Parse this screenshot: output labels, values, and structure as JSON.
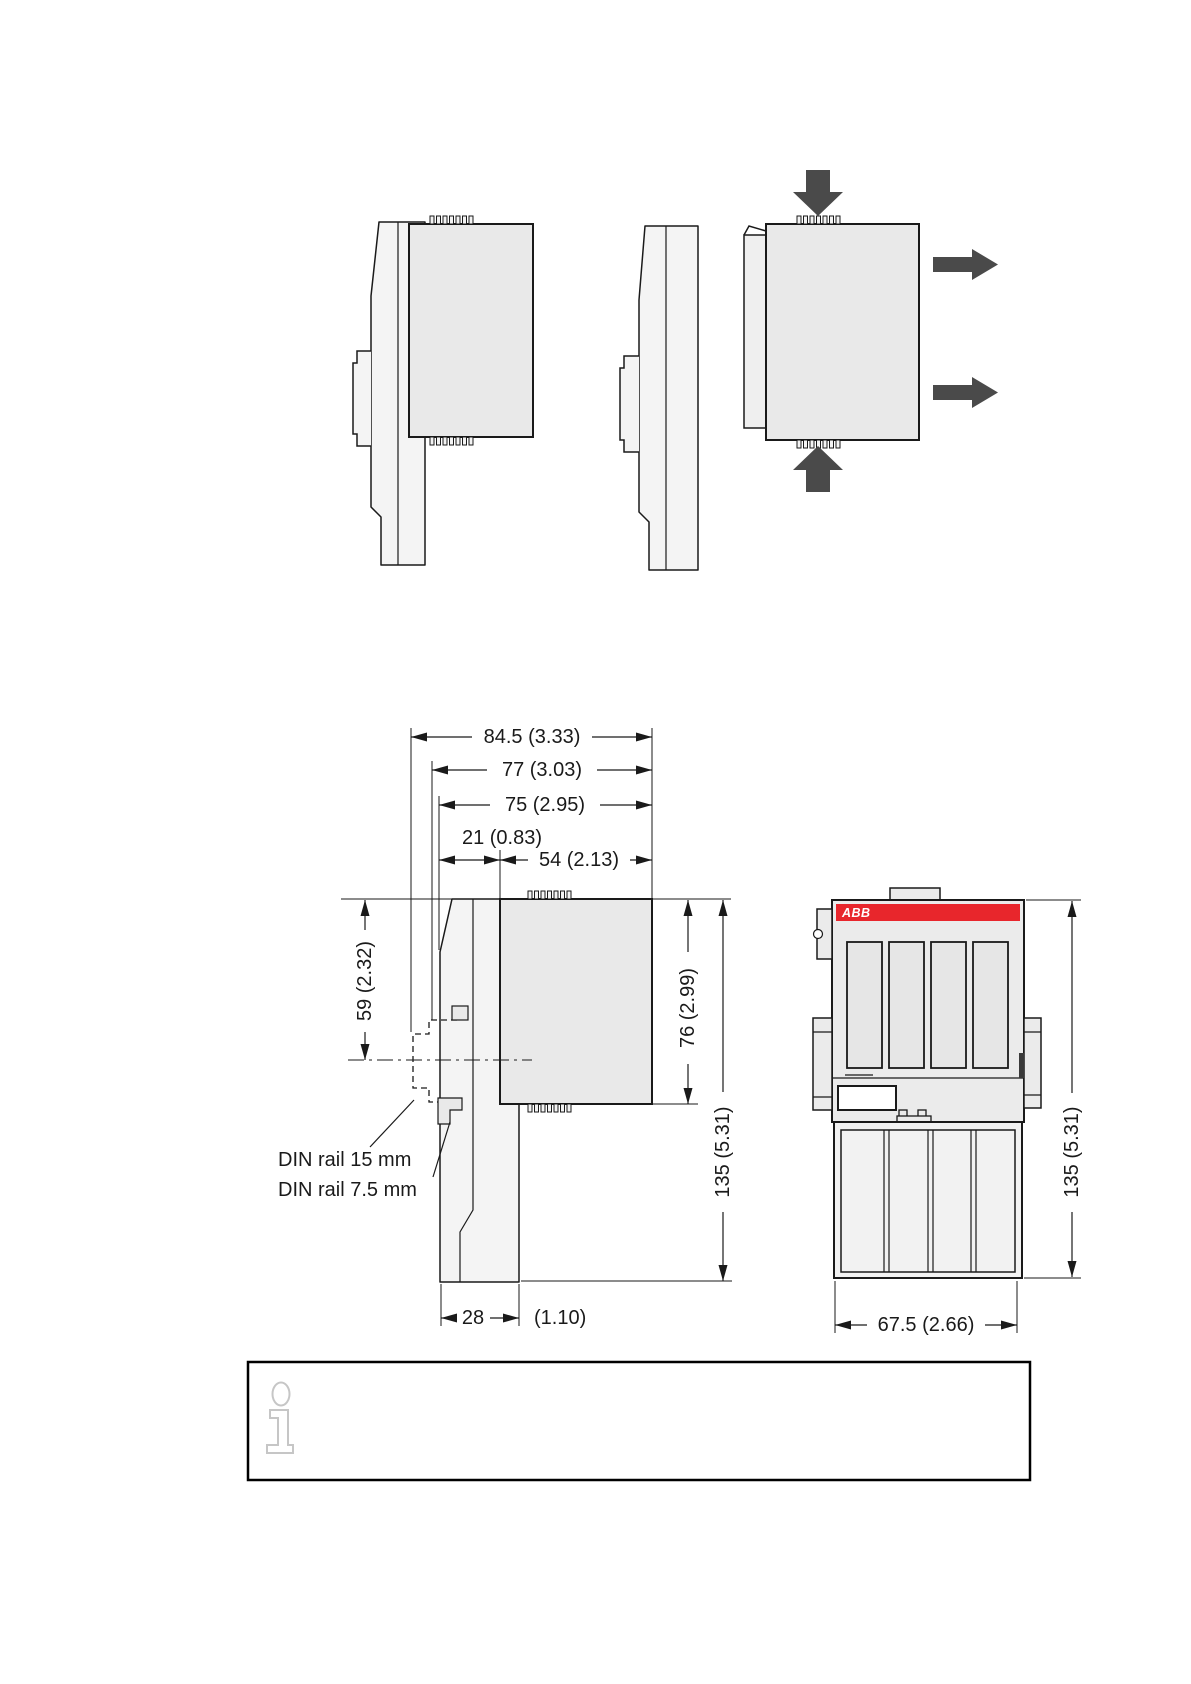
{
  "page": {
    "background": "#ffffff",
    "type": "technical-dimension-drawing-page"
  },
  "colors": {
    "outline": "#1a1a1a",
    "module_fill": "#e9e9e9",
    "panel_fill": "#f4f4f4",
    "front_fill": "#ebebeb",
    "slot_fill": "#e6e6e6",
    "terminal_fill": "#f2f2f2",
    "arrow_gray": "#4a4a4a",
    "abb_red": "#e8262c",
    "info_icon_gray": "#c6c6c6",
    "dim_text": "#1a1a1a"
  },
  "mounting_illustrations": {
    "arrows": {
      "down": "press-down-arrow",
      "up": "press-up-arrow",
      "out_upper": "pull-out-arrow",
      "out_lower": "pull-out-arrow"
    }
  },
  "side_view": {
    "dims": {
      "total_depth": "84.5 (3.33)",
      "depth_77": "77 (3.03)",
      "depth_75": "75 (2.95)",
      "back_offset": "21 (0.83)",
      "module_depth": "54 (2.13)",
      "top_to_rail_center": "59 (2.32)",
      "module_height": "76 (2.99)",
      "total_height": "135 (5.31)",
      "foot_width_mm": "28",
      "foot_width_in": "(1.10)"
    },
    "labels": {
      "din_rail_15": "DIN rail 15 mm",
      "din_rail_7_5": "DIN rail 7.5 mm"
    }
  },
  "front_view": {
    "brand": "ABB",
    "dims": {
      "total_height": "135 (5.31)",
      "width": "67.5 (2.66)"
    }
  }
}
